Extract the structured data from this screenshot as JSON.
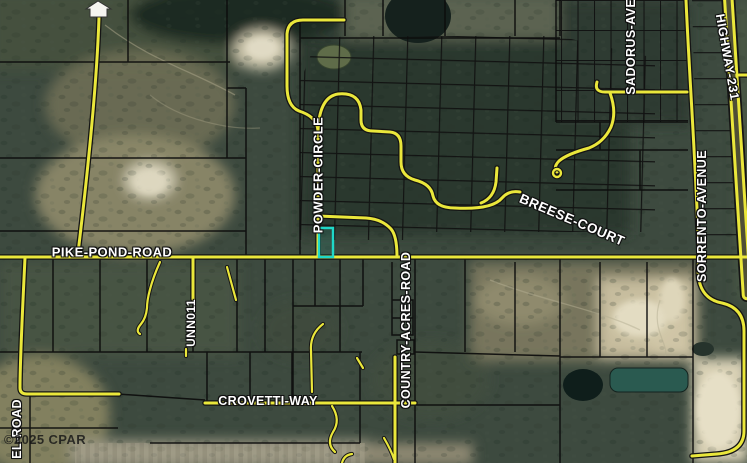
{
  "map": {
    "labels": {
      "pike_pond_road": "PIKE-POND-ROAD",
      "powder_circle": "POWDER-CIRCLE",
      "breese_court": "BREESE-COURT",
      "country_acres_road": "COUNTRY-ACRES-ROAD",
      "crovetti_way": "CROVETTI-WAY",
      "sadorus_avenue": "SADORUS-AVENUE",
      "sorrento_avenue": "SORRENTO-AVENUE",
      "highway_231": "HIGHWAY-231",
      "unn011": "UNN011",
      "el_road": "EL-ROAD"
    },
    "watermark": "©2025 CPAR",
    "icons": {
      "home_marker": "home-marker-icon"
    },
    "colors": {
      "road_yellow": "#eae73b",
      "parcel_line": "#0c0c0c",
      "highlight_teal": "#1fd8c8",
      "label_text": "#ffffff",
      "forest_dark": "#36423a",
      "sand_tan": "#d5cbab",
      "water_teal": "#2a5a50"
    }
  }
}
